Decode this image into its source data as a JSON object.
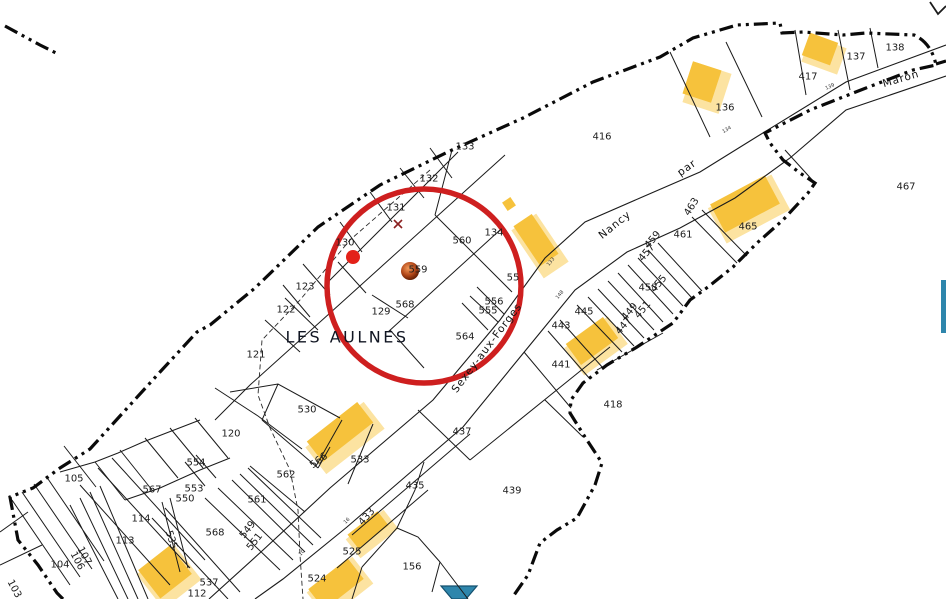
{
  "map": {
    "title": "Plan cadastral",
    "place_label": "LES AULNES",
    "road_labels": [
      {
        "text": "Sexey-aux-Forges",
        "x": 487,
        "y": 348,
        "rot": -53
      },
      {
        "text": "Nancy",
        "x": 615,
        "y": 225,
        "rot": -39
      },
      {
        "text": "par",
        "x": 687,
        "y": 168,
        "rot": -35
      },
      {
        "text": "Maron",
        "x": 901,
        "y": 79,
        "rot": -16
      }
    ],
    "parcel_labels": [
      {
        "text": "133",
        "x": 465,
        "y": 147
      },
      {
        "text": "132",
        "x": 429,
        "y": 179
      },
      {
        "text": "131",
        "x": 396,
        "y": 208
      },
      {
        "text": "130",
        "x": 345,
        "y": 243
      },
      {
        "text": "123",
        "x": 305,
        "y": 287
      },
      {
        "text": "122",
        "x": 286,
        "y": 310
      },
      {
        "text": "121",
        "x": 256,
        "y": 355
      },
      {
        "text": "120",
        "x": 231,
        "y": 434
      },
      {
        "text": "416",
        "x": 602,
        "y": 137
      },
      {
        "text": "136",
        "x": 725,
        "y": 108
      },
      {
        "text": "417",
        "x": 808,
        "y": 77
      },
      {
        "text": "137",
        "x": 856,
        "y": 57
      },
      {
        "text": "138",
        "x": 895,
        "y": 48
      },
      {
        "text": "467",
        "x": 906,
        "y": 187
      },
      {
        "text": "465",
        "x": 748,
        "y": 227
      },
      {
        "text": "461",
        "x": 683,
        "y": 235
      },
      {
        "text": "463",
        "x": 692,
        "y": 207,
        "rot": -58
      },
      {
        "text": "459",
        "x": 653,
        "y": 240,
        "rot": -50
      },
      {
        "text": "457",
        "x": 647,
        "y": 253,
        "rot": -50
      },
      {
        "text": "455",
        "x": 659,
        "y": 284,
        "rot": -50
      },
      {
        "text": "453",
        "x": 648,
        "y": 288
      },
      {
        "text": "451",
        "x": 643,
        "y": 310,
        "rot": -50
      },
      {
        "text": "449",
        "x": 630,
        "y": 312,
        "rot": -50
      },
      {
        "text": "447",
        "x": 624,
        "y": 326,
        "rot": -50
      },
      {
        "text": "445",
        "x": 584,
        "y": 312
      },
      {
        "text": "443",
        "x": 561,
        "y": 326
      },
      {
        "text": "441",
        "x": 561,
        "y": 365
      },
      {
        "text": "418",
        "x": 613,
        "y": 405
      },
      {
        "text": "439",
        "x": 512,
        "y": 491
      },
      {
        "text": "437",
        "x": 462,
        "y": 432
      },
      {
        "text": "435",
        "x": 415,
        "y": 486
      },
      {
        "text": "433",
        "x": 367,
        "y": 517,
        "rot": -48
      },
      {
        "text": "525",
        "x": 352,
        "y": 552
      },
      {
        "text": "524",
        "x": 317,
        "y": 579
      },
      {
        "text": "156",
        "x": 412,
        "y": 567
      },
      {
        "text": "530",
        "x": 307,
        "y": 410
      },
      {
        "text": "533",
        "x": 360,
        "y": 460
      },
      {
        "text": "566",
        "x": 319,
        "y": 461,
        "rot": -36
      },
      {
        "text": "562",
        "x": 286,
        "y": 475
      },
      {
        "text": "561",
        "x": 257,
        "y": 500
      },
      {
        "text": "554",
        "x": 196,
        "y": 463
      },
      {
        "text": "567",
        "x": 152,
        "y": 490
      },
      {
        "text": "553",
        "x": 194,
        "y": 489
      },
      {
        "text": "550",
        "x": 185,
        "y": 499
      },
      {
        "text": "568",
        "x": 215,
        "y": 533
      },
      {
        "text": "114",
        "x": 141,
        "y": 519
      },
      {
        "text": "113",
        "x": 125,
        "y": 541
      },
      {
        "text": "105",
        "x": 74,
        "y": 479
      },
      {
        "text": "104",
        "x": 60,
        "y": 565
      },
      {
        "text": "537",
        "x": 209,
        "y": 583
      },
      {
        "text": "112",
        "x": 197,
        "y": 594
      },
      {
        "text": "107",
        "x": 84,
        "y": 556,
        "rot": 62
      },
      {
        "text": "106",
        "x": 77,
        "y": 561,
        "rot": 62
      },
      {
        "text": "103",
        "x": 14,
        "y": 589,
        "rot": 62
      },
      {
        "text": "535",
        "x": 171,
        "y": 540,
        "rot": 72
      },
      {
        "text": "549",
        "x": 248,
        "y": 530,
        "rot": -52
      },
      {
        "text": "551",
        "x": 255,
        "y": 542,
        "rot": -52
      },
      {
        "text": "560",
        "x": 462,
        "y": 241
      },
      {
        "text": "559",
        "x": 418,
        "y": 270
      },
      {
        "text": "568",
        "x": 405,
        "y": 305
      },
      {
        "text": "129",
        "x": 381,
        "y": 312
      },
      {
        "text": "564",
        "x": 465,
        "y": 337
      },
      {
        "text": "556",
        "x": 494,
        "y": 302
      },
      {
        "text": "555",
        "x": 488,
        "y": 311
      },
      {
        "text": "134",
        "x": 494,
        "y": 233
      },
      {
        "text": "55",
        "x": 513,
        "y": 278
      }
    ],
    "road_ticks": [
      {
        "text": "139",
        "x": 830,
        "y": 87,
        "rot": -25
      },
      {
        "text": "134",
        "x": 727,
        "y": 130,
        "rot": -30
      },
      {
        "text": "133",
        "x": 551,
        "y": 262,
        "rot": -50
      },
      {
        "text": "148",
        "x": 560,
        "y": 295,
        "rot": -50
      },
      {
        "text": "16",
        "x": 347,
        "y": 521,
        "rot": -45
      },
      {
        "text": "10",
        "x": 302,
        "y": 553,
        "rot": -45
      }
    ],
    "annotations": {
      "highlight_circle": {
        "cx": 424,
        "cy": 286,
        "r": 97
      },
      "marker_dot": {
        "cx": 353,
        "cy": 257,
        "r": 7
      },
      "marker_sphere": {
        "cx": 410,
        "cy": 271,
        "r": 9
      },
      "survey_cross": {
        "cx": 398,
        "cy": 224
      }
    },
    "colors": {
      "building": "#F6C23C",
      "building_halo": "#FCE3A1",
      "boundary": "#0a0a0a",
      "parcel_line": "#1b1b1b",
      "water": "#2E86AC",
      "water_border": "#14506E",
      "highlight_red": "#CE1F1F",
      "marker_red": "#E32119",
      "sphere_light": "#F29A5A",
      "sphere_mid": "#B4491A",
      "sphere_dark": "#571800",
      "label": "#1c1c1c",
      "place": "#101522"
    }
  }
}
